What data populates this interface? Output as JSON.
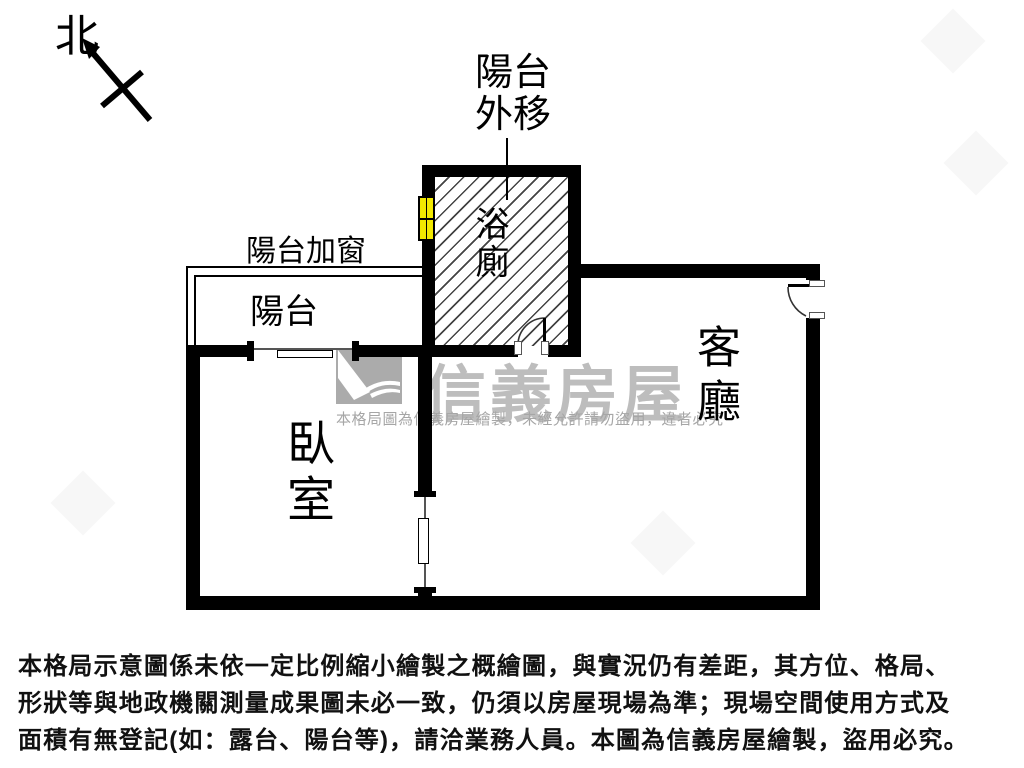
{
  "compass": {
    "north_label": "北"
  },
  "plan": {
    "annotations": {
      "balcony_out_line1": "陽台",
      "balcony_out_line2": "外移",
      "balcony_window": "陽台加窗"
    },
    "rooms": {
      "balcony": "陽台",
      "bathroom": "浴廁",
      "bedroom": "臥室",
      "living_room": "客廳"
    },
    "colors": {
      "wall": "#000000",
      "window_accent": "#f2e900",
      "hatch_line": "#141414"
    }
  },
  "watermark": {
    "brand": "信義房屋",
    "notice": "本格局圖為信義房屋繪製，未經允許請勿盜用，違者必究",
    "brand_color": "#bdbdbd"
  },
  "disclaimer": {
    "lines": [
      "本格局示意圖係未依一定比例縮小繪製之概繪圖，與實況仍有差距，其方位、格局、",
      "形狀等與地政機關測量成果圖未必一致，仍須以房屋現場為準；現場空間使用方式及",
      "面積有無登記(如：露台、陽台等)，請洽業務人員。本圖為信義房屋繪製，盜用必究。"
    ]
  }
}
